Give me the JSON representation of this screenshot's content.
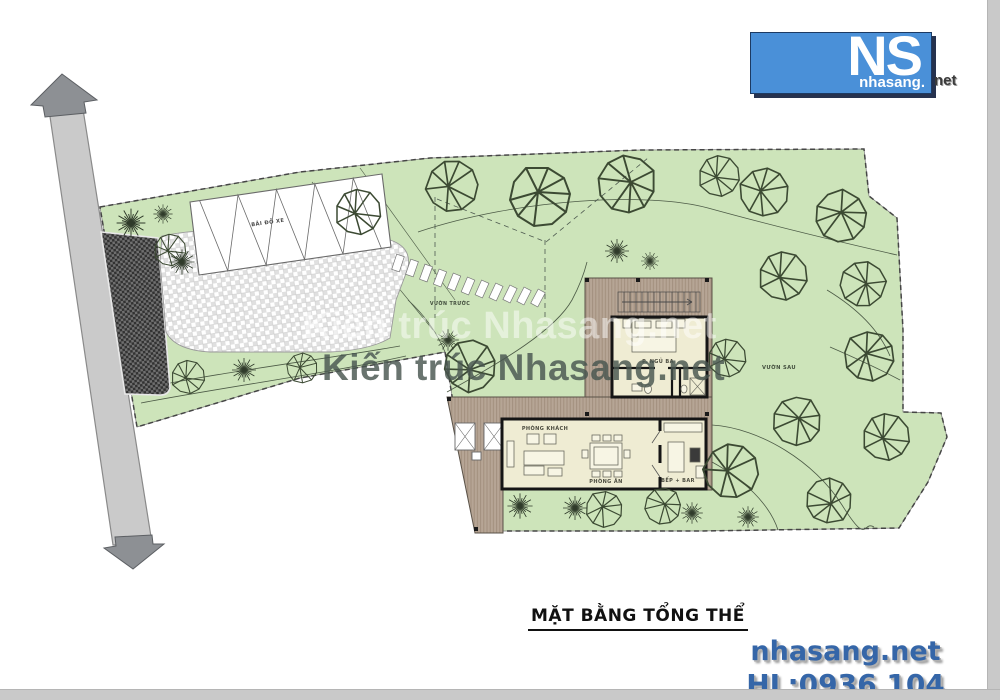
{
  "logo": {
    "ns": "NS",
    "brand": "nhasang.",
    "tld": "net"
  },
  "watermarks": {
    "light": "Kiến trúc Nhasang.net",
    "dark": "Kiến trúc Nhasang.net"
  },
  "plan_labels": {
    "parking": "BÃI ĐỖ XE",
    "front_garden": "VƯỜN TRƯỚC",
    "back_garden": "VƯỜN SAU",
    "living_room": "PHÒNG KHÁCH",
    "dining_room": "PHÒNG ĂN",
    "kitchen": "BẾP + BAR",
    "bedroom": "P. NGỦ BA"
  },
  "title": "MẶT BẰNG TỔNG THỂ",
  "contact": {
    "website": "nhasang.net",
    "hotline": "HL:0936 104 768"
  },
  "colors": {
    "site_green": "#cde4ba",
    "road_gray": "#cacaca",
    "arrow_gray": "#8d9094",
    "deck_wood": "#b6a595",
    "interior_cream": "#efecd3",
    "wall_black": "#151515",
    "logo_blue": "#4a90d8",
    "contact_blue": "#3566a8"
  }
}
